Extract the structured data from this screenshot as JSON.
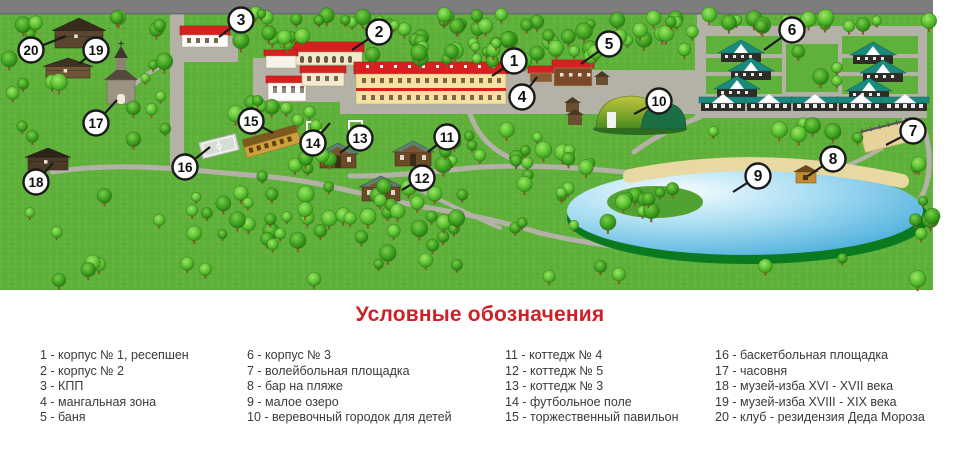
{
  "legend": {
    "title": "Условные обозначения",
    "separator": " - ",
    "columns": [
      [
        {
          "num": "1",
          "label": "корпус № 1, ресепшен"
        },
        {
          "num": "2",
          "label": "корпус № 2"
        },
        {
          "num": "3",
          "label": "КПП"
        },
        {
          "num": "4",
          "label": "мангальная зона"
        },
        {
          "num": "5",
          "label": "баня"
        }
      ],
      [
        {
          "num": "6",
          "label": "корпус № 3"
        },
        {
          "num": "7",
          "label": "волейбольная площадка"
        },
        {
          "num": "8",
          "label": "бар на пляже"
        },
        {
          "num": "9",
          "label": "малое озеро"
        },
        {
          "num": "10",
          "label": "веревочный городок для детей"
        }
      ],
      [
        {
          "num": "11",
          "label": "коттедж № 4"
        },
        {
          "num": "12",
          "label": "коттедж № 5"
        },
        {
          "num": "13",
          "label": "коттедж № 3"
        },
        {
          "num": "14",
          "label": "футбольное поле"
        },
        {
          "num": "15",
          "label": "торжественный павильон"
        }
      ],
      [
        {
          "num": "16",
          "label": "баскетбольная площадка"
        },
        {
          "num": "17",
          "label": "часовня"
        },
        {
          "num": "18",
          "label": "музей-изба XVI - XVII века"
        },
        {
          "num": "19",
          "label": "музей-изба XVIII - XIX века"
        },
        {
          "num": "20",
          "label": "клуб - резидензия Деда Мороза"
        }
      ]
    ]
  },
  "map": {
    "markers": [
      {
        "n": "1",
        "x": 514,
        "y": 61,
        "tx": 492,
        "ty": 76
      },
      {
        "n": "2",
        "x": 379,
        "y": 32,
        "tx": 352,
        "ty": 50
      },
      {
        "n": "3",
        "x": 241,
        "y": 20,
        "tx": 219,
        "ty": 37
      },
      {
        "n": "4",
        "x": 522,
        "y": 97,
        "tx": 537,
        "ty": 77
      },
      {
        "n": "5",
        "x": 609,
        "y": 44,
        "tx": 581,
        "ty": 64
      },
      {
        "n": "6",
        "x": 792,
        "y": 30,
        "tx": 764,
        "ty": 50
      },
      {
        "n": "7",
        "x": 913,
        "y": 131,
        "tx": 886,
        "ty": 145
      },
      {
        "n": "8",
        "x": 833,
        "y": 159,
        "tx": 808,
        "ty": 176
      },
      {
        "n": "9",
        "x": 758,
        "y": 176,
        "tx": 733,
        "ty": 192
      },
      {
        "n": "10",
        "x": 659,
        "y": 101,
        "tx": 634,
        "ty": 114
      },
      {
        "n": "11",
        "x": 447,
        "y": 137,
        "tx": 428,
        "ty": 152
      },
      {
        "n": "12",
        "x": 422,
        "y": 178,
        "tx": 402,
        "ty": 190
      },
      {
        "n": "13",
        "x": 360,
        "y": 138,
        "tx": 340,
        "ty": 153
      },
      {
        "n": "14",
        "x": 313,
        "y": 143,
        "tx": 330,
        "ty": 123
      },
      {
        "n": "15",
        "x": 251,
        "y": 121,
        "tx": 273,
        "ty": 133
      },
      {
        "n": "16",
        "x": 185,
        "y": 167,
        "tx": 210,
        "ty": 147
      },
      {
        "n": "17",
        "x": 96,
        "y": 123,
        "tx": 117,
        "ty": 100
      },
      {
        "n": "18",
        "x": 36,
        "y": 182,
        "tx": 53,
        "ty": 163
      },
      {
        "n": "19",
        "x": 96,
        "y": 50,
        "tx": 79,
        "ty": 64
      },
      {
        "n": "20",
        "x": 31,
        "y": 50,
        "tx": 66,
        "ty": 36
      }
    ]
  },
  "colors": {
    "legend_title": "#cf2027",
    "grass": "#5fb13c",
    "road_top": "#7d7d7d",
    "path": "#b4b1a6",
    "lake": "#49b0dd",
    "lake_rim": "#0a7a20",
    "sand": "#e8d8a2",
    "roof_red": "#d82020",
    "roof_teal": "#1b8a7e",
    "marker_fill": "#ffffff",
    "marker_stroke": "#1a1a1a"
  }
}
